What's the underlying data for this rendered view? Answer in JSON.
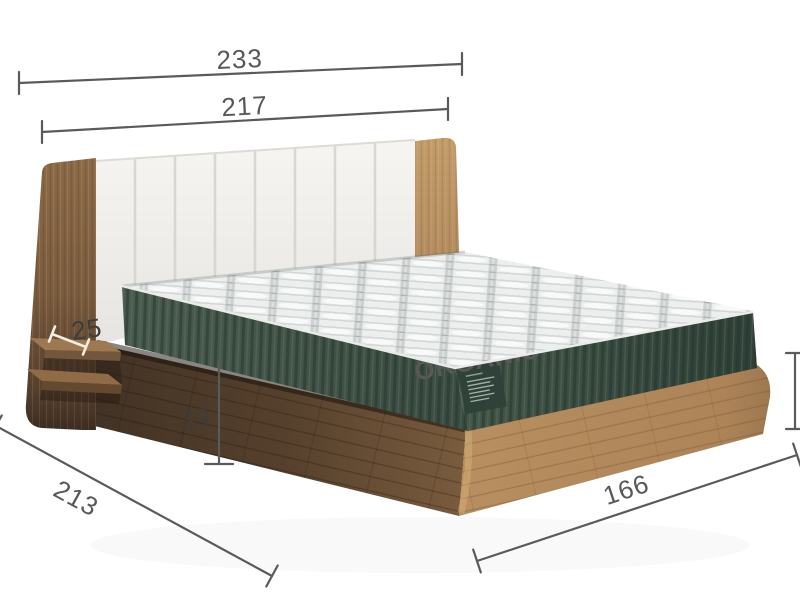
{
  "scene": {
    "type": "bed-dimension-diagram",
    "mattress_label": {
      "title": "ORGANIC"
    },
    "dimensions": {
      "total_width": "233",
      "headboard_width": "217",
      "shelf_depth": "25",
      "base_height": "39",
      "side_depth": "213",
      "foot_width": "166"
    },
    "colors": {
      "dimension_line": "#5a5a5a",
      "dimension_text": "#585858",
      "dimension_text_dark": "#3d3d3d",
      "wood_light": "#b9915f",
      "wood_dark": "#6d5339",
      "mattress_green": "#3d5044",
      "headboard_white": "#f3f2ef",
      "quilt_gray": "#c7ccca"
    }
  }
}
